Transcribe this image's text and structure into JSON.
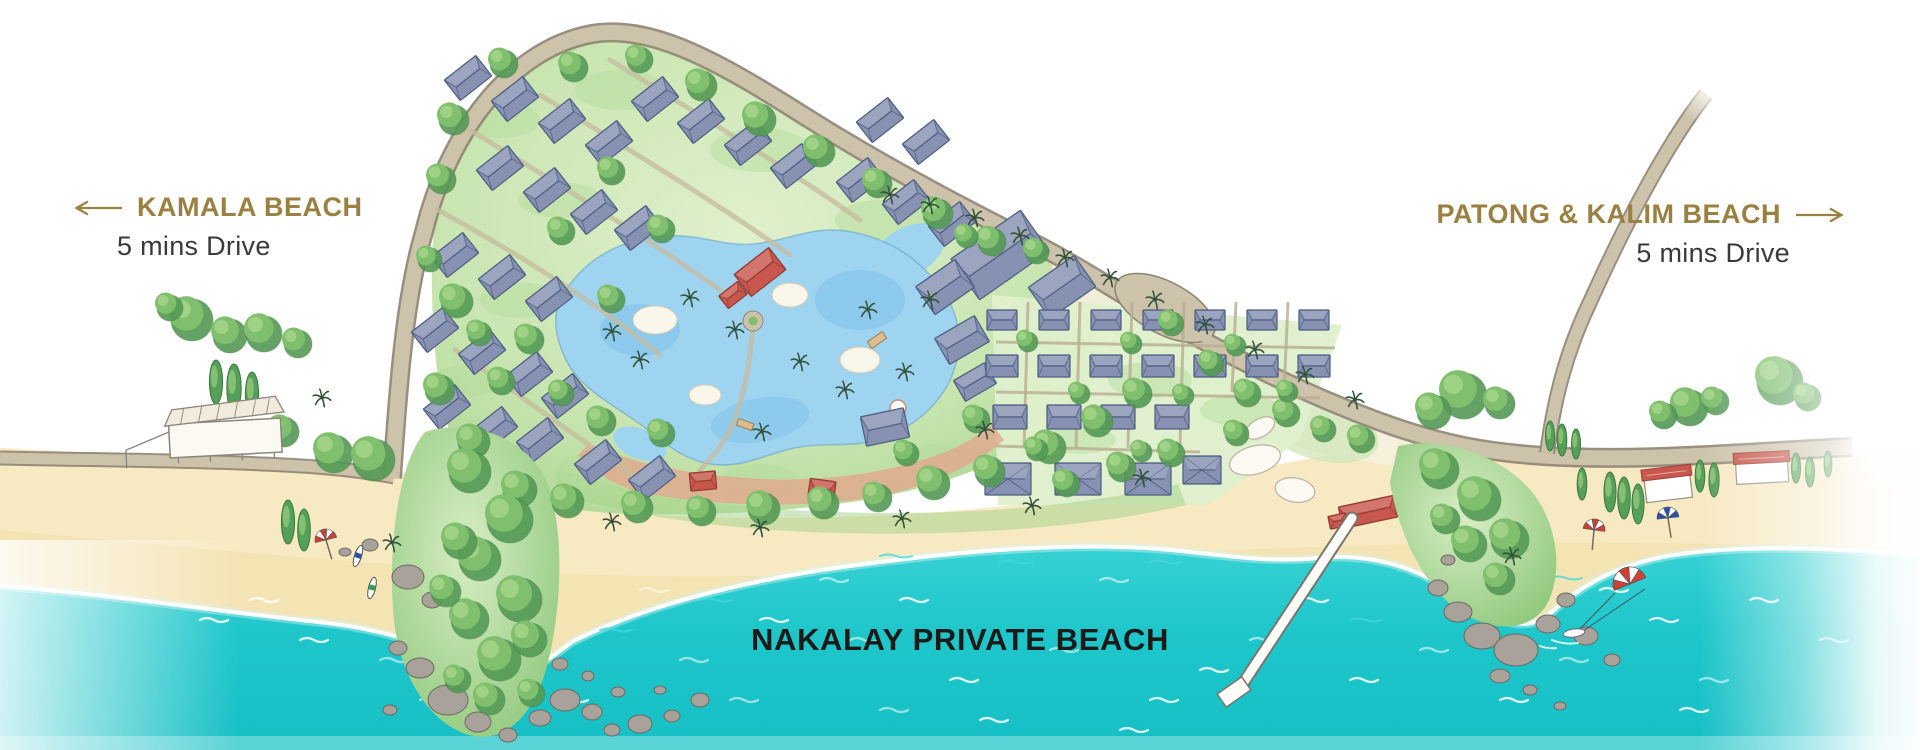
{
  "page": {
    "title": "Nakalay Private Beach Resort Map"
  },
  "labels": {
    "left": {
      "title": "KAMALA BEACH",
      "subtitle": "5 mins Drive",
      "arrow_icon": "left-arrow"
    },
    "right": {
      "title": "PATONG & KALIM BEACH",
      "subtitle": "5 mins Drive",
      "arrow_icon": "right-arrow"
    },
    "center": {
      "title": "NAKALAY PRIVATE BEACH"
    }
  },
  "palette": {
    "accent_gold": "#9a8142",
    "label_dark": "#3a3a3a",
    "label_black": "#1a1a18",
    "ocean": "#1cc6ca",
    "ocean_deep": "#14bfc4",
    "ocean_light": "#6fe0e0",
    "sand": "#f7e9c2",
    "sand_deep": "#f1dda4",
    "road_fill": "#cdc3ab",
    "road_edge": "#8d8372",
    "green_wash": "#cfe7ba",
    "green_mid": "#a9d58e",
    "tree_green": "#7fbf6e",
    "tree_light": "#a5d58a",
    "tree_dark": "#549a55",
    "cypress": "#55a058",
    "palm_dark": "#33513a",
    "roof_blue": "#8792b2",
    "roof_dark": "#4c5c80",
    "roof_red": "#c8574d",
    "pool_blue": "#9fd4f1",
    "pool_deep": "#7cc0e8",
    "deck": "#e2a88e",
    "rock": "#a8a29b"
  }
}
